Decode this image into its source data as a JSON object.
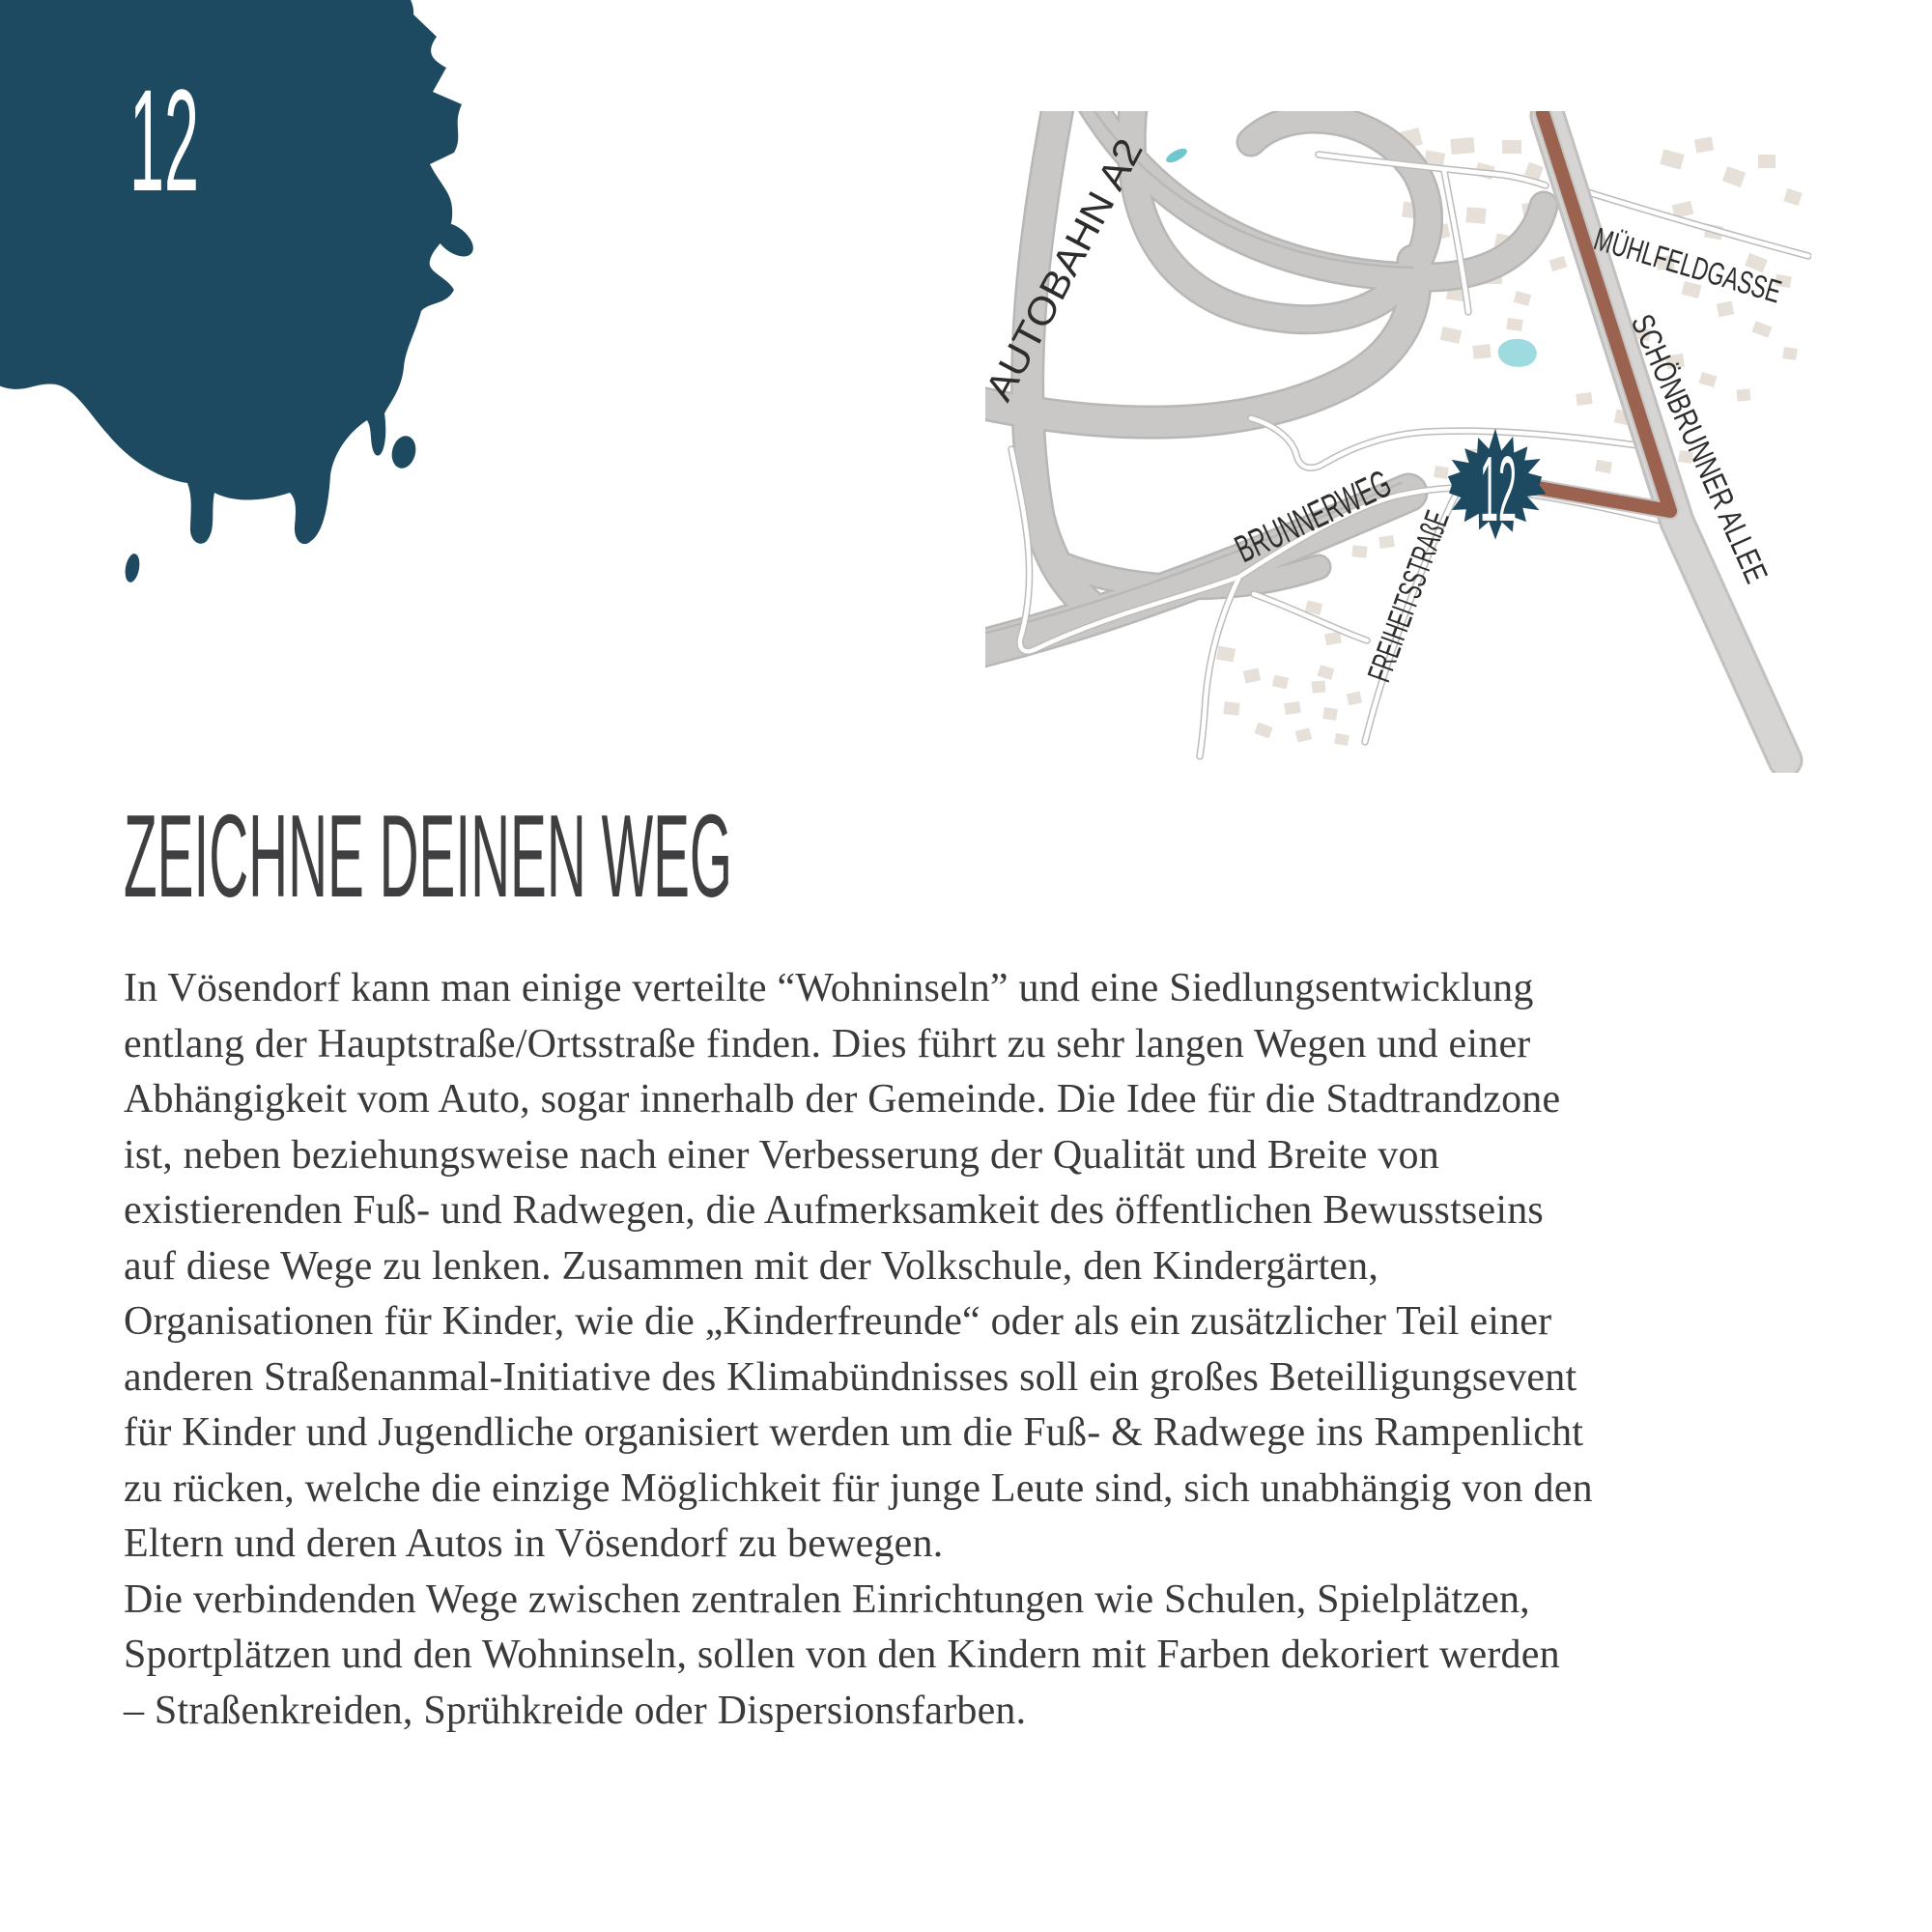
{
  "page": {
    "number": "12",
    "heading": "ZEICHNE DEINEN WEG",
    "body_lines": [
      "In Vösendorf kann man einige verteilte “Wohninseln” und eine Siedlungsentwicklung",
      "entlang der Hauptstraße/Ortsstraße finden. Dies führt zu sehr langen Wegen und einer",
      "Abhängigkeit vom Auto, sogar innerhalb der Gemeinde. Die Idee für die Stadtrandzone",
      "ist, neben beziehungsweise nach einer Verbesserung der Qualität und Breite von",
      "existierenden Fuß- und Radwegen, die Aufmerksamkeit des öffentlichen Bewusstseins",
      "auf diese Wege zu lenken. Zusammen mit der Volkschule, den Kindergärten,",
      "Organisationen für Kinder, wie die „Kinderfreunde“ oder als ein zusätzlicher Teil einer",
      "anderen Straßenanmal-Initiative des Klimabündnisses soll ein großes Beteilligungsevent",
      "für Kinder und Jugendliche organisiert werden um die Fuß- & Radwege ins Rampenlicht",
      "zu rücken, welche die einzige Möglichkeit für junge Leute sind, sich unabhängig von den",
      "Eltern und deren Autos in Vösendorf zu bewegen.",
      "Die verbindenden Wege zwischen zentralen Einrichtungen wie Schulen, Spielplätzen,",
      "Sportplätzen und den Wohninseln, sollen von den Kindern mit Farben dekoriert werden",
      "– Straßenkreiden, Sprühkreide oder Dispersionsfarben."
    ]
  },
  "map": {
    "marker_number": "12",
    "labels": {
      "autobahn": "AUTOBAHN A2",
      "muehlfeldgasse": "MÜHLFELDGASSE",
      "schoenbrunner": "SCHÖNBRUNNER ALLEE",
      "brunnerweg": "BRUNNERWEG",
      "freiheitsstrasse": "FREIHEITSSTRAßE"
    }
  },
  "colors": {
    "ink": "#1d4a60",
    "route_brown": "#9a624f",
    "road_gray": "#c9c8c6",
    "allee_gray": "#d5d4d2",
    "building_beige": "#e6e0d9",
    "water_teal": "#9edbe0",
    "text_gray": "#3a3a3a"
  }
}
